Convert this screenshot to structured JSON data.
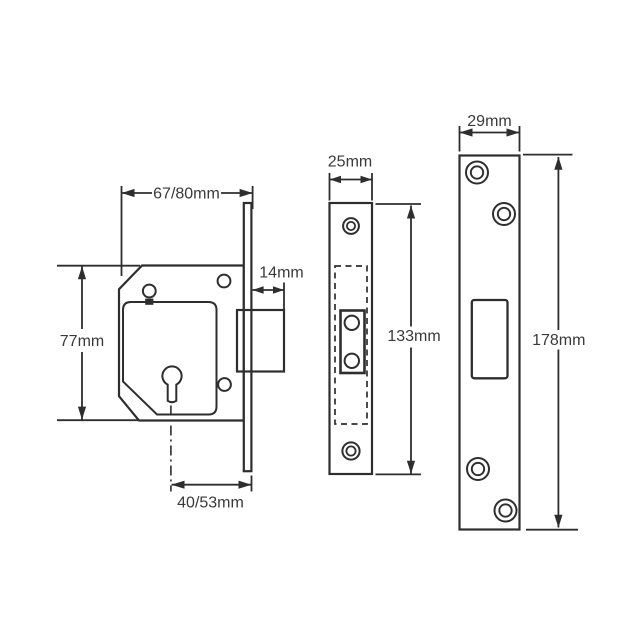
{
  "drawing": {
    "background": "#ffffff",
    "line_color": "#2e2e2e",
    "text_color": "#3a3a3a",
    "views": {
      "lock_body_side": {
        "dims": {
          "case_depth": "67/80mm",
          "bolt_throw": "14mm",
          "case_height": "77mm",
          "backset": "40/53mm"
        }
      },
      "faceplate_front": {
        "dims": {
          "width": "25mm",
          "height": "133mm"
        }
      },
      "forend_plate": {
        "dims": {
          "width": "29mm",
          "height": "178mm"
        }
      }
    }
  }
}
